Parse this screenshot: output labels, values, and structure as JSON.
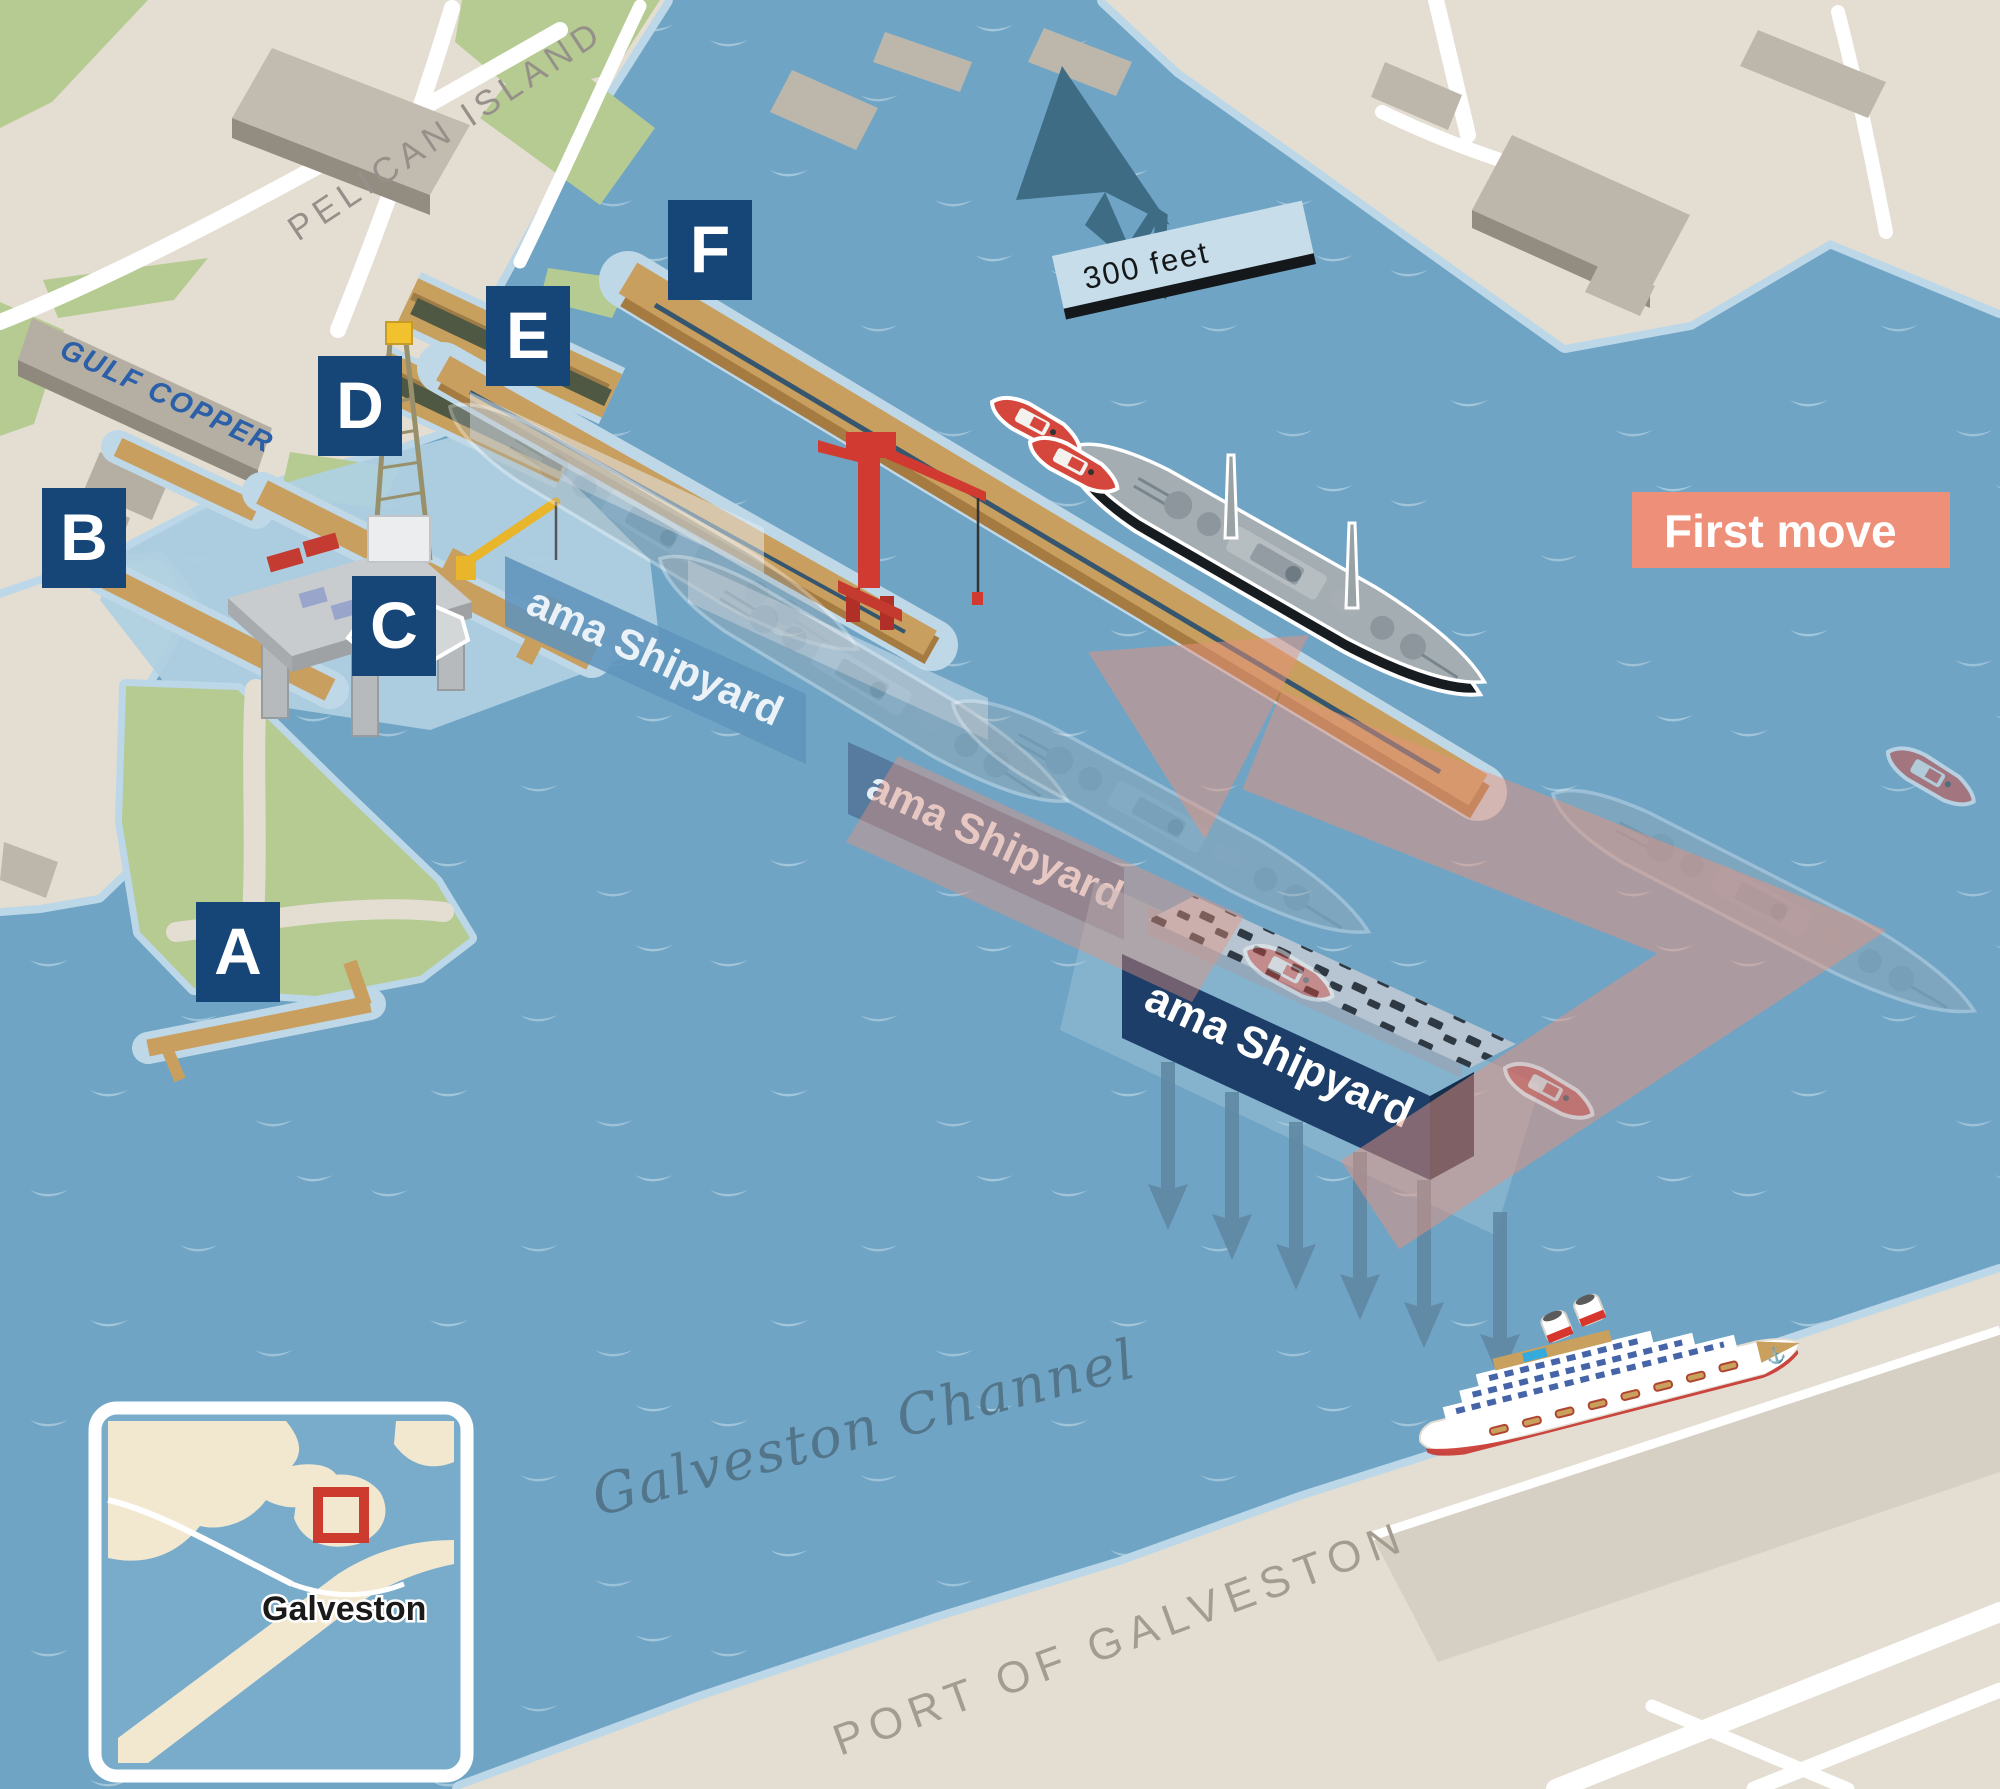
{
  "labels": {
    "pelican_island": "PELICAN ISLAND",
    "port_of_galveston": "PORT OF GALVESTON",
    "channel_name": "Galveston Channel",
    "gulf_copper": "GULF COPPER",
    "first_move": "First move",
    "scale_bar": "300 feet",
    "compass_north": "N",
    "shipyard_sign": "ama Shipyard",
    "helipad": "H"
  },
  "berths": [
    {
      "letter": "A"
    },
    {
      "letter": "B"
    },
    {
      "letter": "C"
    },
    {
      "letter": "D"
    },
    {
      "letter": "E"
    },
    {
      "letter": "F"
    }
  ],
  "inset_map": {
    "city_label": "Galveston"
  },
  "icons": {
    "anchor": "⚓"
  },
  "colors": {
    "water": "#6FA4C5",
    "shallow_water": "#B3D2E2",
    "land": "#E4DED2",
    "green_space": "#B6CB92",
    "pier_tan": "#C99F5F",
    "label_box": "#164577",
    "first_move_box": "#EE9079",
    "move_arrow": "#E8927C",
    "dry_dock_navy": "#1D3E68",
    "compass": "#3E6C84",
    "crane_red": "#D13A30",
    "tug_red": "#D5473C",
    "battleship_gray": "#A4ADB2",
    "inset_marker_red": "#CD3B2F",
    "gulf_copper_blue": "#2B5FA8"
  }
}
